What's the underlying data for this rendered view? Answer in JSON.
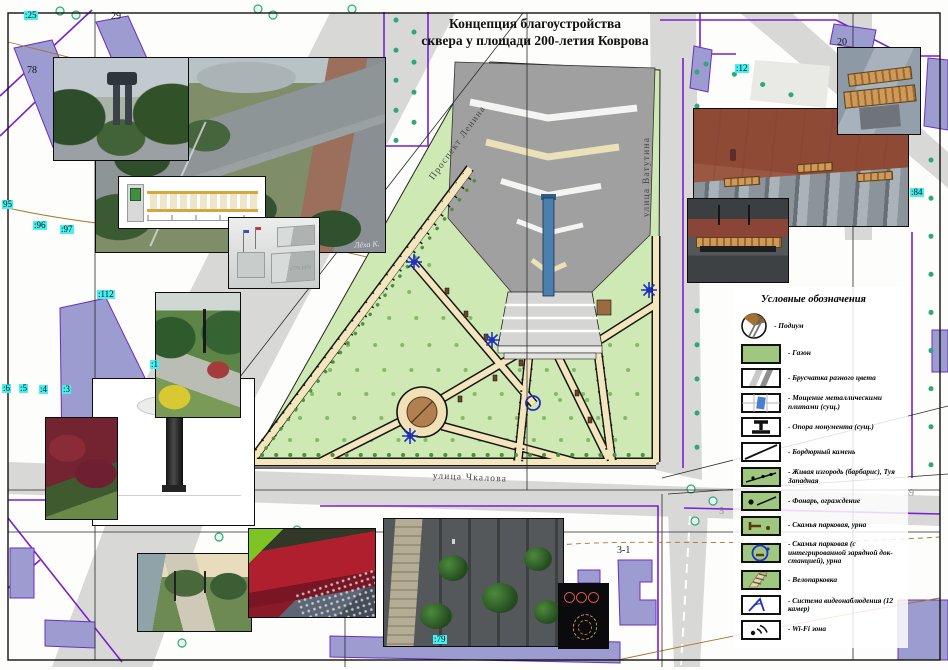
{
  "sheet": {
    "title_line1": "Концепция благоустройства",
    "title_line2": "сквера у площади 200-летия Коврова"
  },
  "streets": {
    "lenina": "Проспект Ленина",
    "vatutina": "улица Ватутина",
    "chkalova": "улица Чкалова"
  },
  "legend": {
    "title": "Условные обозначения",
    "items": [
      {
        "icon": "podium",
        "label": "- Подиум"
      },
      {
        "icon": "lawn",
        "label": "- Газон"
      },
      {
        "icon": "pavers",
        "label": "- Брусчатка разного цвета"
      },
      {
        "icon": "metal-plates",
        "label": "- Мощение металлическими плитами (сущ.)"
      },
      {
        "icon": "monument-support",
        "label": "- Опора монумента (сущ.)"
      },
      {
        "icon": "curb",
        "label": "- Бордюрный камень"
      },
      {
        "icon": "hedge",
        "label": "- Живая изгородь (барбарис), Туя Западная"
      },
      {
        "icon": "lantern-fence",
        "label": "- Фонарь, ограждение"
      },
      {
        "icon": "bench-urn",
        "label": "- Скамья парковая, урна"
      },
      {
        "icon": "bench-charging",
        "label": "- Скамья парковая (с интегрированной зарядной док-станцией), урна"
      },
      {
        "icon": "bike-parking",
        "label": "- Велопарковка"
      },
      {
        "icon": "cctv",
        "label": "- Система видеонаблюдения (12 камер)"
      },
      {
        "icon": "wifi",
        "label": "- Wi-Fi зона"
      }
    ]
  },
  "map": {
    "parcel_labels": [
      {
        "text": ":25",
        "style": "cyan"
      },
      {
        "text": "29",
        "style": "plain"
      },
      {
        "text": "78",
        "style": "plain"
      },
      {
        "text": "95",
        "style": "cyan"
      },
      {
        "text": ":96",
        "style": "cyan"
      },
      {
        "text": ":97",
        "style": "cyan"
      },
      {
        "text": ":112",
        "style": "cyan"
      },
      {
        "text": ":6",
        "style": "cyan"
      },
      {
        "text": ":5",
        "style": "cyan"
      },
      {
        "text": ":4",
        "style": "cyan"
      },
      {
        "text": ":3",
        "style": "cyan"
      },
      {
        "text": ":1",
        "style": "cyan"
      },
      {
        "text": ":12",
        "style": "cyan"
      },
      {
        "text": "20",
        "style": "plain"
      },
      {
        "text": ":84",
        "style": "cyan"
      },
      {
        "text": "3-1",
        "style": "plain"
      },
      {
        "text": ":79",
        "style": "cyan"
      },
      {
        "text": "57",
        "style": "gray"
      },
      {
        "text": "59",
        "style": "gray"
      },
      {
        "text": "5",
        "style": "gray"
      }
    ]
  },
  "photos": {
    "aerial_signature": "Лёха К.",
    "stela_text": "1778 1978"
  },
  "colors": {
    "label_highlight": "#45f0ef",
    "parcel_line": "#7a1fd0",
    "building_fill": "#9c9cd0",
    "lawn": "#cfe9b4",
    "path": "#f3e6bd",
    "podium": "#a87848",
    "symbol_blue": "#2030c0",
    "road": "#d8d8d6"
  }
}
